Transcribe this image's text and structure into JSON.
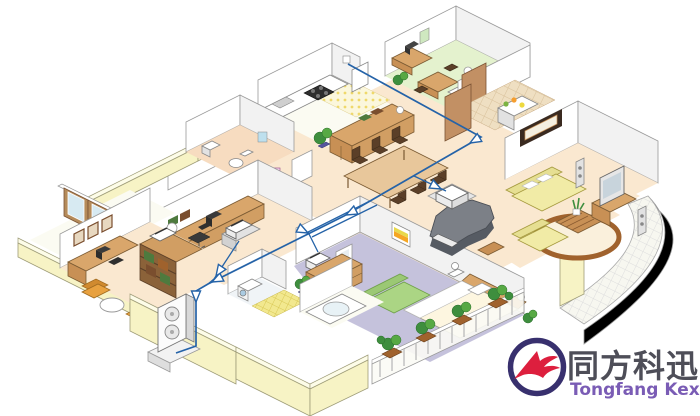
{
  "page": {
    "width": 700,
    "height": 416,
    "background": "#ffffff",
    "description": "Isometric cutaway illustration of an apartment showing structured home-network cabling (blue lines with white arrowheads) linking devices in every room"
  },
  "logo": {
    "brand_cn": "同方科迅",
    "brand_en": "Tongfang Kexun",
    "cn_color": "#4e4e58",
    "en_color": "#7a5cb5",
    "ring_color": "#38306e",
    "flag_color": "#dd1f3e"
  },
  "palette": {
    "cable": "#2563a8",
    "wall_yellow": "#f7f3c5",
    "floor_cream": "#fae8d0",
    "floor_green": "#e4f2ce",
    "floor_peach": "#f7dcc0",
    "floor_lavender": "#c5c2dc",
    "wood": "#d9a66b",
    "sofa_yellow": "#f1eba6",
    "sofa_green": "#abd584",
    "piano_gray": "#7c8087",
    "rug_brown": "#a0622d",
    "logo_cn": "#4e4e58",
    "logo_en": "#7a5cb5"
  },
  "rooms": [
    {
      "id": "green-bedroom",
      "label": "study bedroom",
      "floor": "green",
      "furniture": [
        "desk with computer",
        "small table with chairs",
        "single bed with lamp"
      ]
    },
    {
      "id": "kitchen",
      "label": "kitchen",
      "floor": "white with yellow mat",
      "furniture": [
        "counter",
        "stove",
        "sink",
        "fridge"
      ]
    },
    {
      "id": "bathroom",
      "label": "bathroom / WC",
      "floor": "peach",
      "furniture": [
        "toilet",
        "wash basin",
        "mirror"
      ]
    },
    {
      "id": "vanity-corner",
      "label": "dressing corner",
      "floor": "cream",
      "furniture": [
        "pink vanity table",
        "wardrobe"
      ]
    },
    {
      "id": "study",
      "label": "study room",
      "floor": "cream",
      "furniture": [
        "desk with monitor",
        "office chair",
        "cabinet with fax device",
        "table lamp"
      ]
    },
    {
      "id": "sunroom",
      "label": "veranda with sliding doors",
      "floor": "white",
      "furniture": [
        "sliding glass doors"
      ]
    },
    {
      "id": "den-office",
      "label": "den / home office",
      "floor": "cream",
      "furniture": [
        "desk with computer",
        "bookshelf",
        "armchair",
        "round table",
        "wall pictures"
      ]
    },
    {
      "id": "laundry-bath",
      "label": "laundry and bathtub rooms",
      "floor": "tile",
      "furniture": [
        "washing machine",
        "bathtub",
        "yellow tiled shower floor"
      ]
    },
    {
      "id": "dining-room",
      "label": "dining room",
      "floor": "cream",
      "furniture": [
        "dining table with six chairs",
        "sideboard",
        "potted plant"
      ]
    },
    {
      "id": "entrance-hall",
      "label": "entrance hall",
      "floor": "tan tile",
      "furniture": [
        "shoe cabinet with fruit bowl",
        "wooden door"
      ]
    },
    {
      "id": "living-room",
      "label": "living room",
      "floor": "cream",
      "furniture": [
        "yellow sofa set",
        "round brown rug",
        "coffee table with plant",
        "TV on stand",
        "tower speakers",
        "framed picture",
        "grand piano with bench"
      ]
    },
    {
      "id": "master-bedroom",
      "label": "master bedroom",
      "floor": "lavender",
      "furniture": [
        "double bed",
        "green sofa",
        "dresser with mirror",
        "bedside lamps",
        "plants"
      ]
    },
    {
      "id": "south-balcony",
      "label": "balcony with railing and plants",
      "floor": "lavender"
    },
    {
      "id": "east-balcony",
      "label": "curved tiled balcony",
      "floor": "white tile"
    }
  ],
  "devices": [
    {
      "id": "network-hub",
      "label": "network hub near piano"
    },
    {
      "id": "study-fax-device",
      "label": "fax / network device in study"
    },
    {
      "id": "office-shelf-device",
      "label": "device on office bookshelf"
    },
    {
      "id": "bedroom-media-device",
      "label": "media device in master bedroom"
    },
    {
      "id": "outdoor-ac-unit",
      "label": "outdoor air-conditioner unit with two fans"
    }
  ],
  "network": {
    "cable_color": "#2563a8",
    "arrow_style": "white triangular arrowheads outlined in blue along cable runs",
    "runs": [
      "trunk from upper-right bedroom across dining room and study down the outside wall to the outdoor unit",
      "branch to hub beside the grand piano",
      "branch into master bedroom media device",
      "branch from study fax device"
    ]
  }
}
